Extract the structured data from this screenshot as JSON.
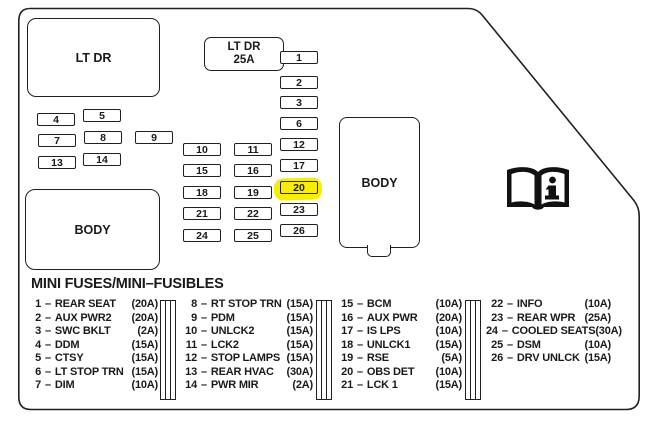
{
  "panel": {
    "large_connector_label": "LT DR",
    "fuse_25a_connector": {
      "line1": "LT DR",
      "line2": "25A"
    },
    "body_connector_left": "BODY",
    "body_connector_right": "BODY",
    "highlighted_fuse": "20",
    "colors": {
      "highlight": "#f8ee00",
      "line": "#231f20"
    },
    "slots": {
      "right_col": [
        "1",
        "2",
        "3",
        "6",
        "12",
        "17",
        "20",
        "23",
        "26"
      ],
      "mid_left_col": [
        "10",
        "15",
        "18",
        "21",
        "24"
      ],
      "mid_right_col": [
        "11",
        "16",
        "19",
        "22",
        "25"
      ],
      "cluster": [
        "4",
        "5",
        "7",
        "8",
        "9",
        "13",
        "14"
      ]
    }
  },
  "icons": {
    "manual_reference": "open-book-info-icon",
    "column_divider": "mini-fuse-icon"
  },
  "legend": {
    "title": "MINI FUSES/MINI–FUSIBLES",
    "separator": "–",
    "columns": [
      {
        "items": [
          {
            "num": "1",
            "label": "REAR SEAT",
            "amp": "(20A)"
          },
          {
            "num": "2",
            "label": "AUX PWR2",
            "amp": "(20A)"
          },
          {
            "num": "3",
            "label": "SWC BKLT",
            "amp": "(2A)"
          },
          {
            "num": "4",
            "label": "DDM",
            "amp": "(15A)"
          },
          {
            "num": "5",
            "label": "CTSY",
            "amp": "(15A)"
          },
          {
            "num": "6",
            "label": "LT STOP TRN",
            "amp": "(15A)"
          },
          {
            "num": "7",
            "label": "DIM",
            "amp": "(10A)"
          }
        ]
      },
      {
        "items": [
          {
            "num": "8",
            "label": "RT STOP TRN",
            "amp": "(15A)"
          },
          {
            "num": "9",
            "label": "PDM",
            "amp": "(15A)"
          },
          {
            "num": "10",
            "label": "UNLCK2",
            "amp": "(15A)"
          },
          {
            "num": "11",
            "label": "LCK2",
            "amp": "(15A)"
          },
          {
            "num": "12",
            "label": "STOP LAMPS",
            "amp": "(15A)"
          },
          {
            "num": "13",
            "label": "REAR HVAC",
            "amp": "(30A)"
          },
          {
            "num": "14",
            "label": "PWR MIR",
            "amp": "(2A)"
          }
        ]
      },
      {
        "items": [
          {
            "num": "15",
            "label": "BCM",
            "amp": "(10A)"
          },
          {
            "num": "16",
            "label": "AUX PWR",
            "amp": "(20A)"
          },
          {
            "num": "17",
            "label": "IS LPS",
            "amp": "(10A)"
          },
          {
            "num": "18",
            "label": "UNLCK1",
            "amp": "(15A)"
          },
          {
            "num": "19",
            "label": "RSE",
            "amp": "(5A)"
          },
          {
            "num": "20",
            "label": "OBS DET",
            "amp": "(10A)"
          },
          {
            "num": "21",
            "label": "LCK 1",
            "amp": "(15A)"
          }
        ]
      },
      {
        "items": [
          {
            "num": "22",
            "label": "INFO",
            "amp": "(10A)"
          },
          {
            "num": "23",
            "label": "REAR WPR",
            "amp": "(25A)"
          },
          {
            "num": "24",
            "label": "COOLED SEATS",
            "amp": "(30A)"
          },
          {
            "num": "25",
            "label": "DSM",
            "amp": "(10A)"
          },
          {
            "num": "26",
            "label": "DRV UNLCK",
            "amp": "(15A)"
          }
        ]
      }
    ]
  }
}
